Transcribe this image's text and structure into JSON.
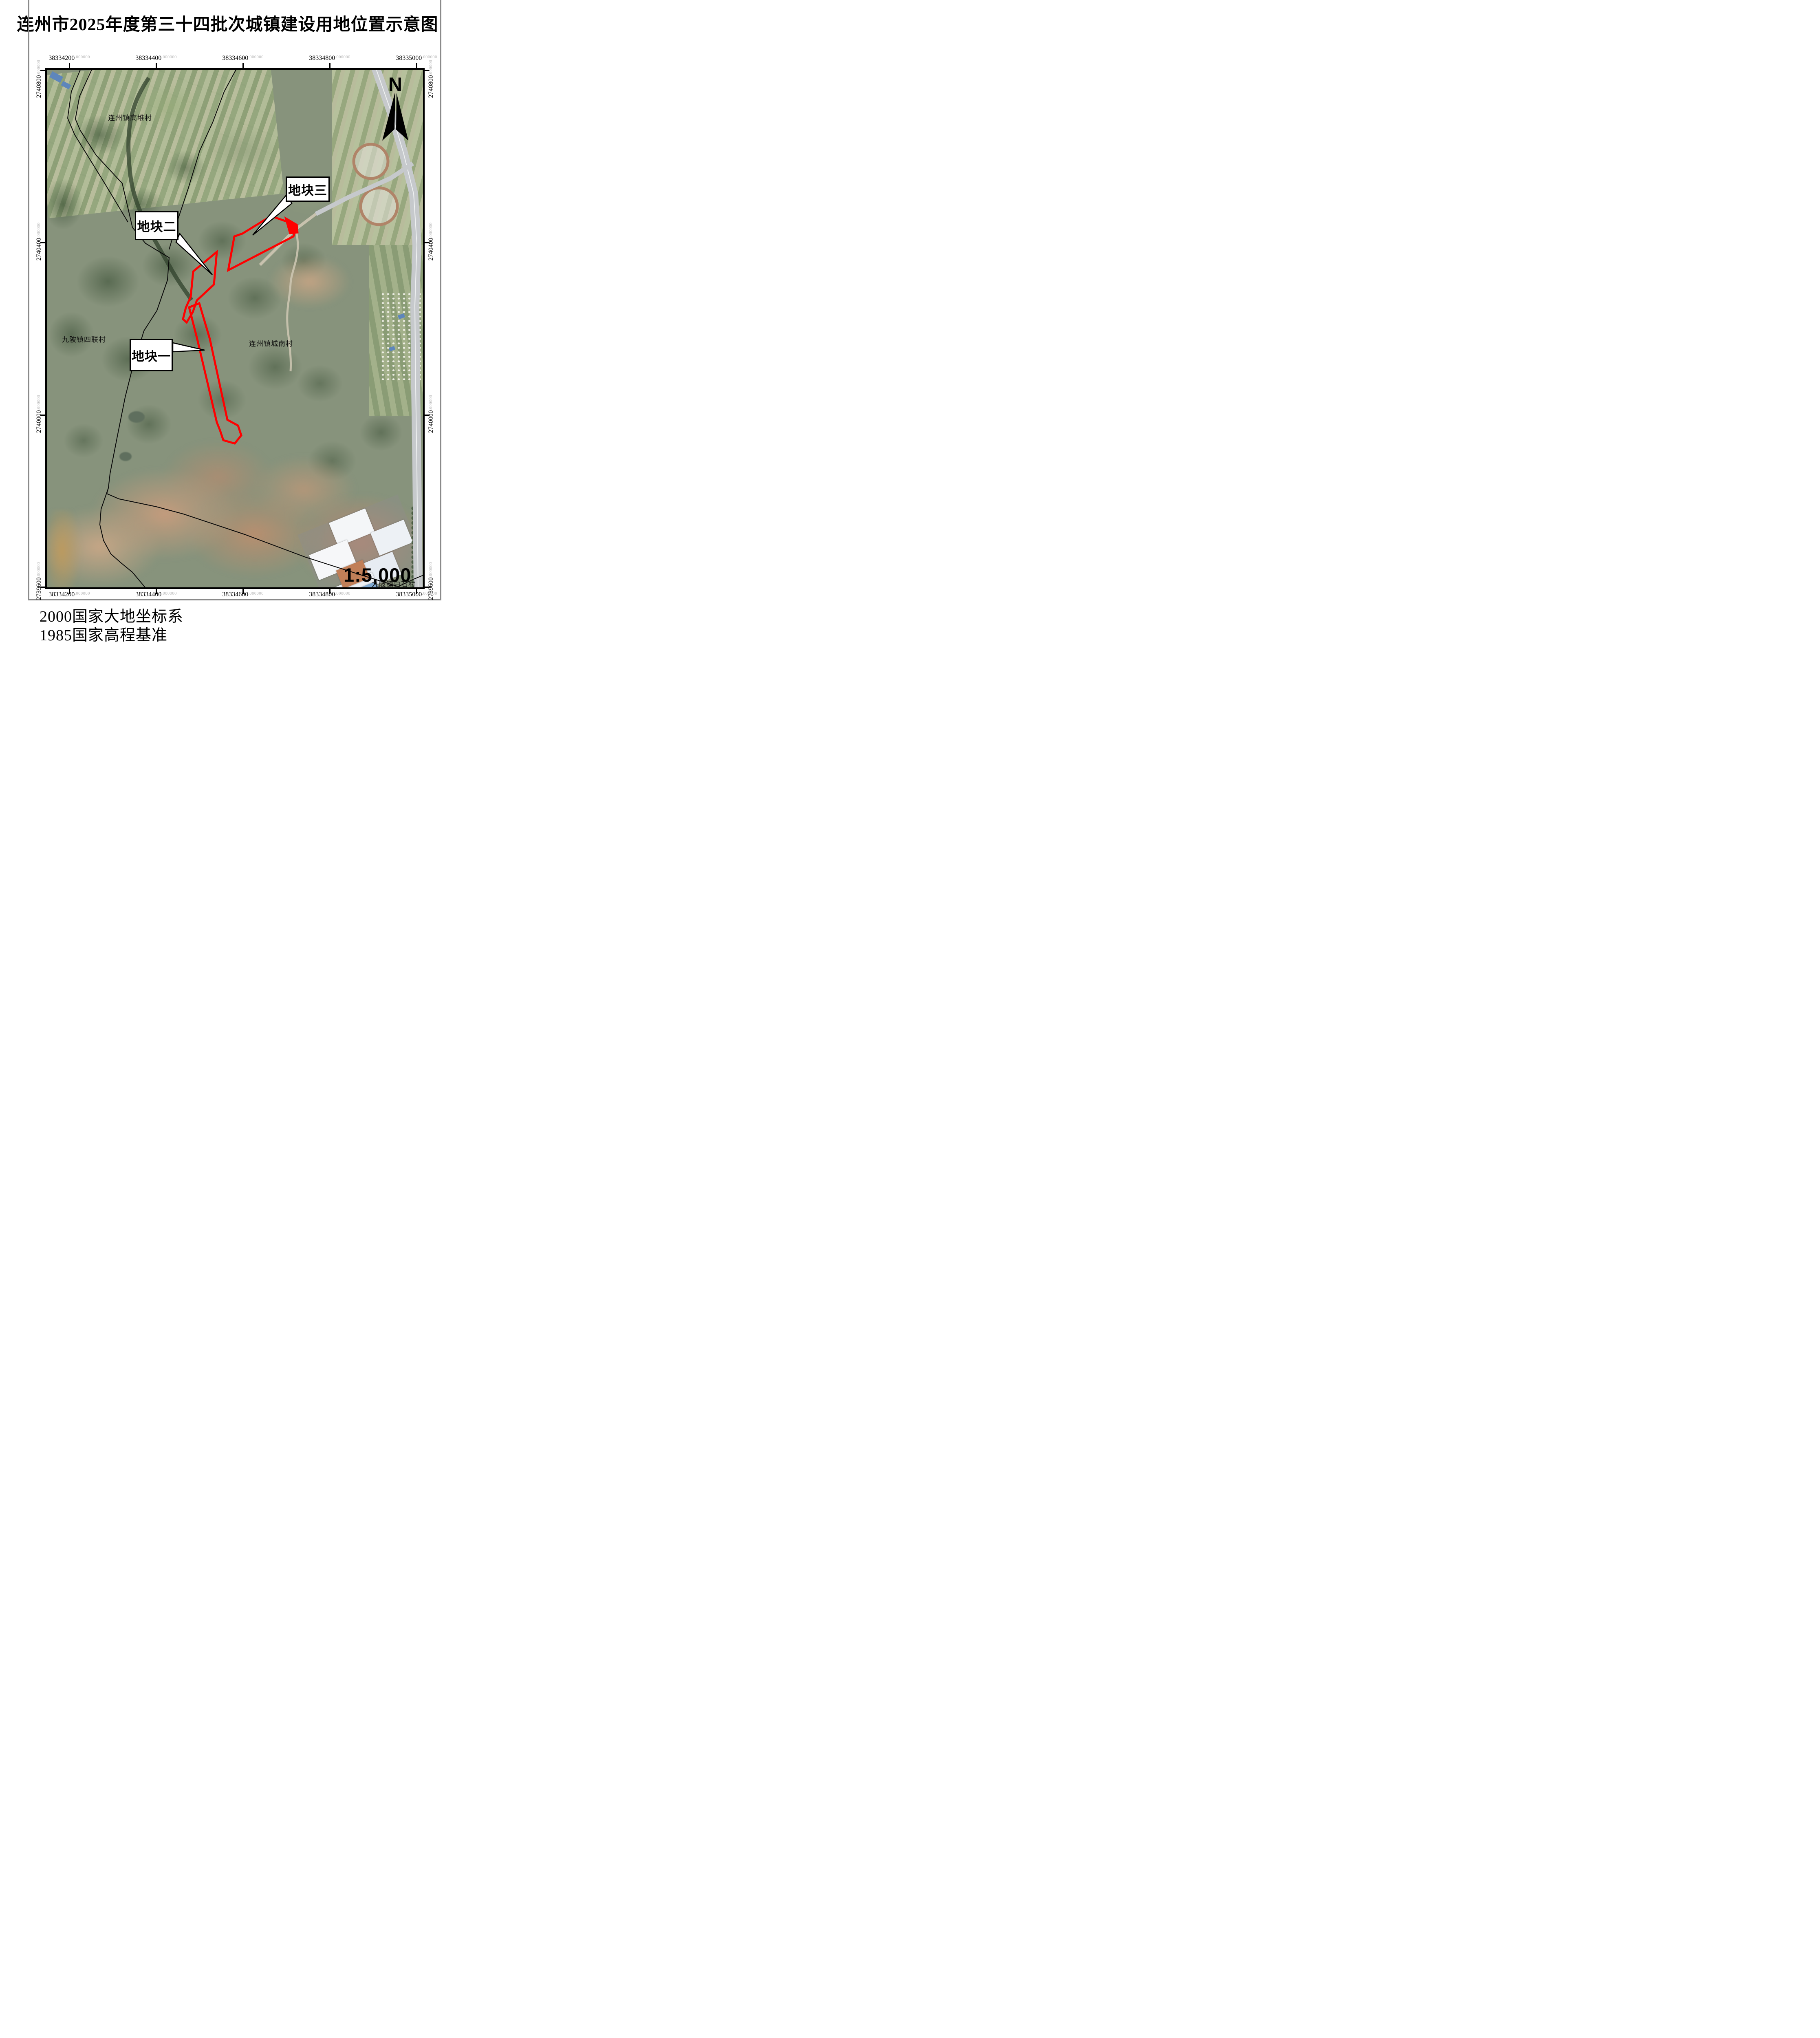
{
  "title": "连州市2025年度第三十四批次城镇建设用地位置示意图",
  "coords": {
    "suffix": ".000000",
    "top": [
      "38334200",
      "38334400",
      "38334600",
      "38334800",
      "38335000"
    ],
    "bottom": [
      "38334200",
      "38334400",
      "38334600",
      "38334800",
      "38335000"
    ],
    "left": [
      "2740800",
      "2740400",
      "2740000",
      "2739600"
    ],
    "right": [
      "2740800",
      "2740400",
      "2740000",
      "2739600"
    ]
  },
  "compass": {
    "label": "N"
  },
  "scale_bar": {
    "text": "1:5,000"
  },
  "villages": {
    "gaodui": "连州镇高堆村",
    "silian": "九陂镇四联村",
    "chengnan": "连州镇城南村",
    "baishi": "九陂镇白石村"
  },
  "parcels": {
    "one": "地块一",
    "two": "地块二",
    "three": "地块三"
  },
  "footer": {
    "datum": "2000国家大地坐标系",
    "height_datum": "1985国家高程基准"
  },
  "colors": {
    "parcel_outline": "#ff0000",
    "boundary_line": "#0a0a0a",
    "map_frame": "#000000",
    "coord_fraction": "#b9b9b9",
    "page_border": "#8a8a8a",
    "road_fill": "#c6c9cc",
    "north_arrow": "#000000"
  }
}
